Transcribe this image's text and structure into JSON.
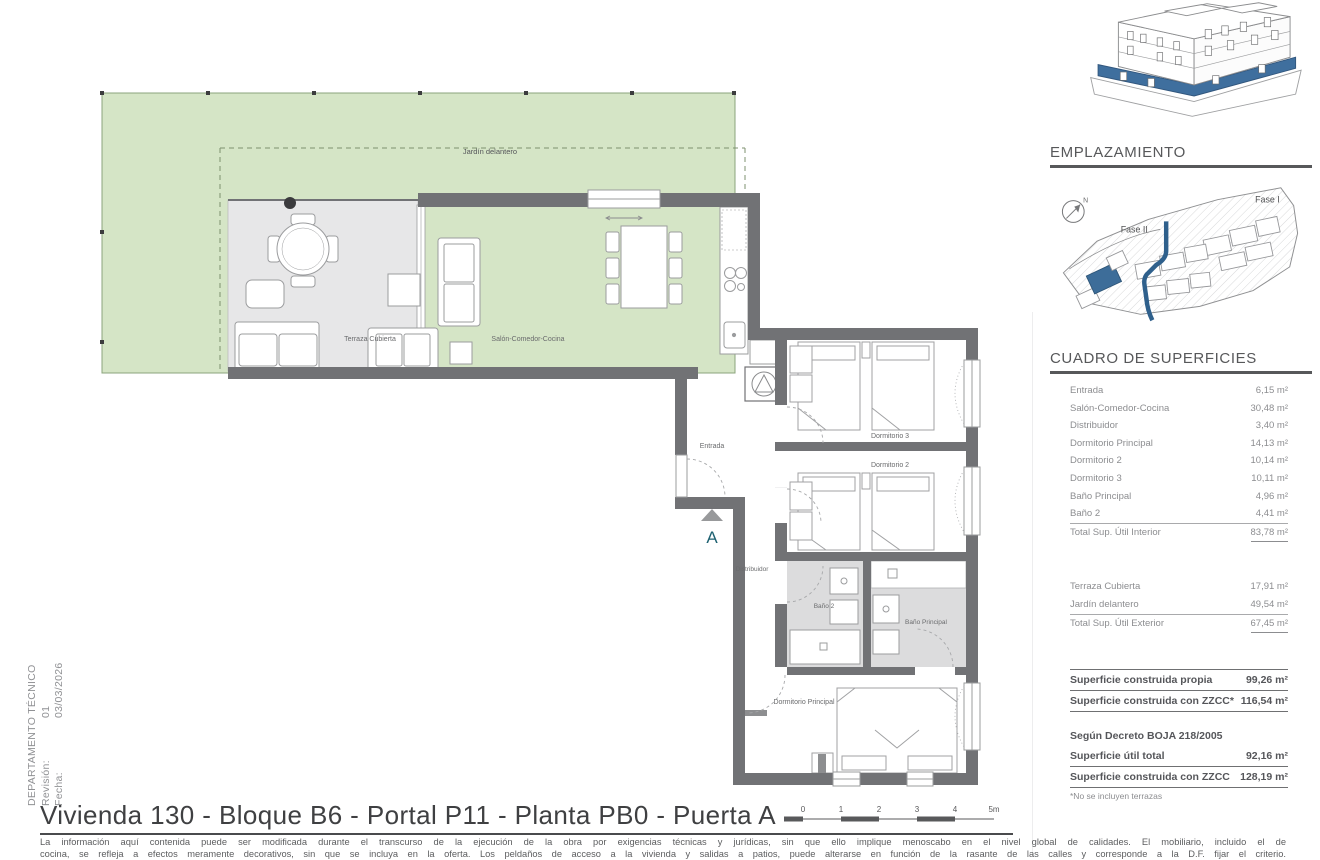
{
  "stamp": {
    "department": "DEPARTAMENTO TÉCNICO",
    "revision_label": "Revisión:",
    "revision_value": "01",
    "date_label": "Fecha:",
    "date_value": "03/03/2026"
  },
  "plan": {
    "labels": {
      "jardin": "Jardín delantero",
      "terraza": "Terraza Cubierta",
      "salon": "Salón-Comedor-Cocina",
      "entrada": "Entrada",
      "dormitorio3": "Dormitorio 3",
      "dormitorio2": "Dormitorio 2",
      "distribuidor": "Distribuidor",
      "bano2": "Baño 2",
      "bano_principal": "Baño Principal",
      "dormitorio_principal": "Dormitorio Principal",
      "marker": "A"
    }
  },
  "sidebar": {
    "emplazamiento": {
      "title": "EMPLAZAMIENTO",
      "fase1": "Fase I",
      "fase2": "Fase II",
      "north": "N"
    },
    "superficies": {
      "title": "CUADRO DE SUPERFICIES",
      "interior_rows": [
        {
          "label": "Entrada",
          "value": "6,15 m²"
        },
        {
          "label": "Salón-Comedor-Cocina",
          "value": "30,48 m²"
        },
        {
          "label": "Distribuidor",
          "value": "3,40 m²"
        },
        {
          "label": "Dormitorio Principal",
          "value": "14,13 m²"
        },
        {
          "label": "Dormitorio 2",
          "value": "10,14 m²"
        },
        {
          "label": "Dormitorio 3",
          "value": "10,11 m²"
        },
        {
          "label": "Baño Principal",
          "value": "4,96 m²"
        },
        {
          "label": "Baño 2",
          "value": "4,41 m²"
        }
      ],
      "interior_total": {
        "label": "Total Sup. Útil Interior",
        "value": "83,78 m²"
      },
      "exterior_rows": [
        {
          "label": "Terraza Cubierta",
          "value": "17,91 m²"
        },
        {
          "label": "Jardín delantero",
          "value": "49,54 m²"
        }
      ],
      "exterior_total": {
        "label": "Total Sup. Útil Exterior",
        "value": "67,45 m²"
      },
      "construida_rows": [
        {
          "label": "Superficie construida propia",
          "value": "99,26 m²"
        },
        {
          "label": "Superficie construida con ZZCC*",
          "value": "116,54 m²"
        }
      ],
      "decreto_title": "Según Decreto BOJA 218/2005",
      "decreto_rows": [
        {
          "label": "Superficie útil total",
          "value": "92,16 m²"
        },
        {
          "label": "Superficie construida con ZZCC",
          "value": "128,19 m²"
        }
      ],
      "footnote": "*No se incluyen terrazas"
    }
  },
  "footer": {
    "title": "Vivienda 130 - Bloque B6 - Portal P11 - Planta PB0 - Puerta A",
    "scalebar": [
      "0",
      "1",
      "2",
      "3",
      "4",
      "5m"
    ],
    "disclaimer_line1": "La información aquí contenida puede ser modificada durante el transcurso de la ejecución de la obra por exigencias técnicas y jurídicas, sin que ello implique menoscabo en el nivel global de calidades. El mobiliario, incluido el de",
    "disclaimer_line2": "cocina, se refleja a efectos meramente decorativos, sin que se incluya en la oferta. Los peldaños de acceso a la vivienda y salidas a patios, puede alterarse en función de la rasante de las calles y corresponde a la D.F. fijar el criterio."
  },
  "colors": {
    "garden_green": "#d5e5c6",
    "wall_gray": "#717275",
    "accent_blue": "#3d6d99",
    "marker_teal": "#1f6272"
  }
}
